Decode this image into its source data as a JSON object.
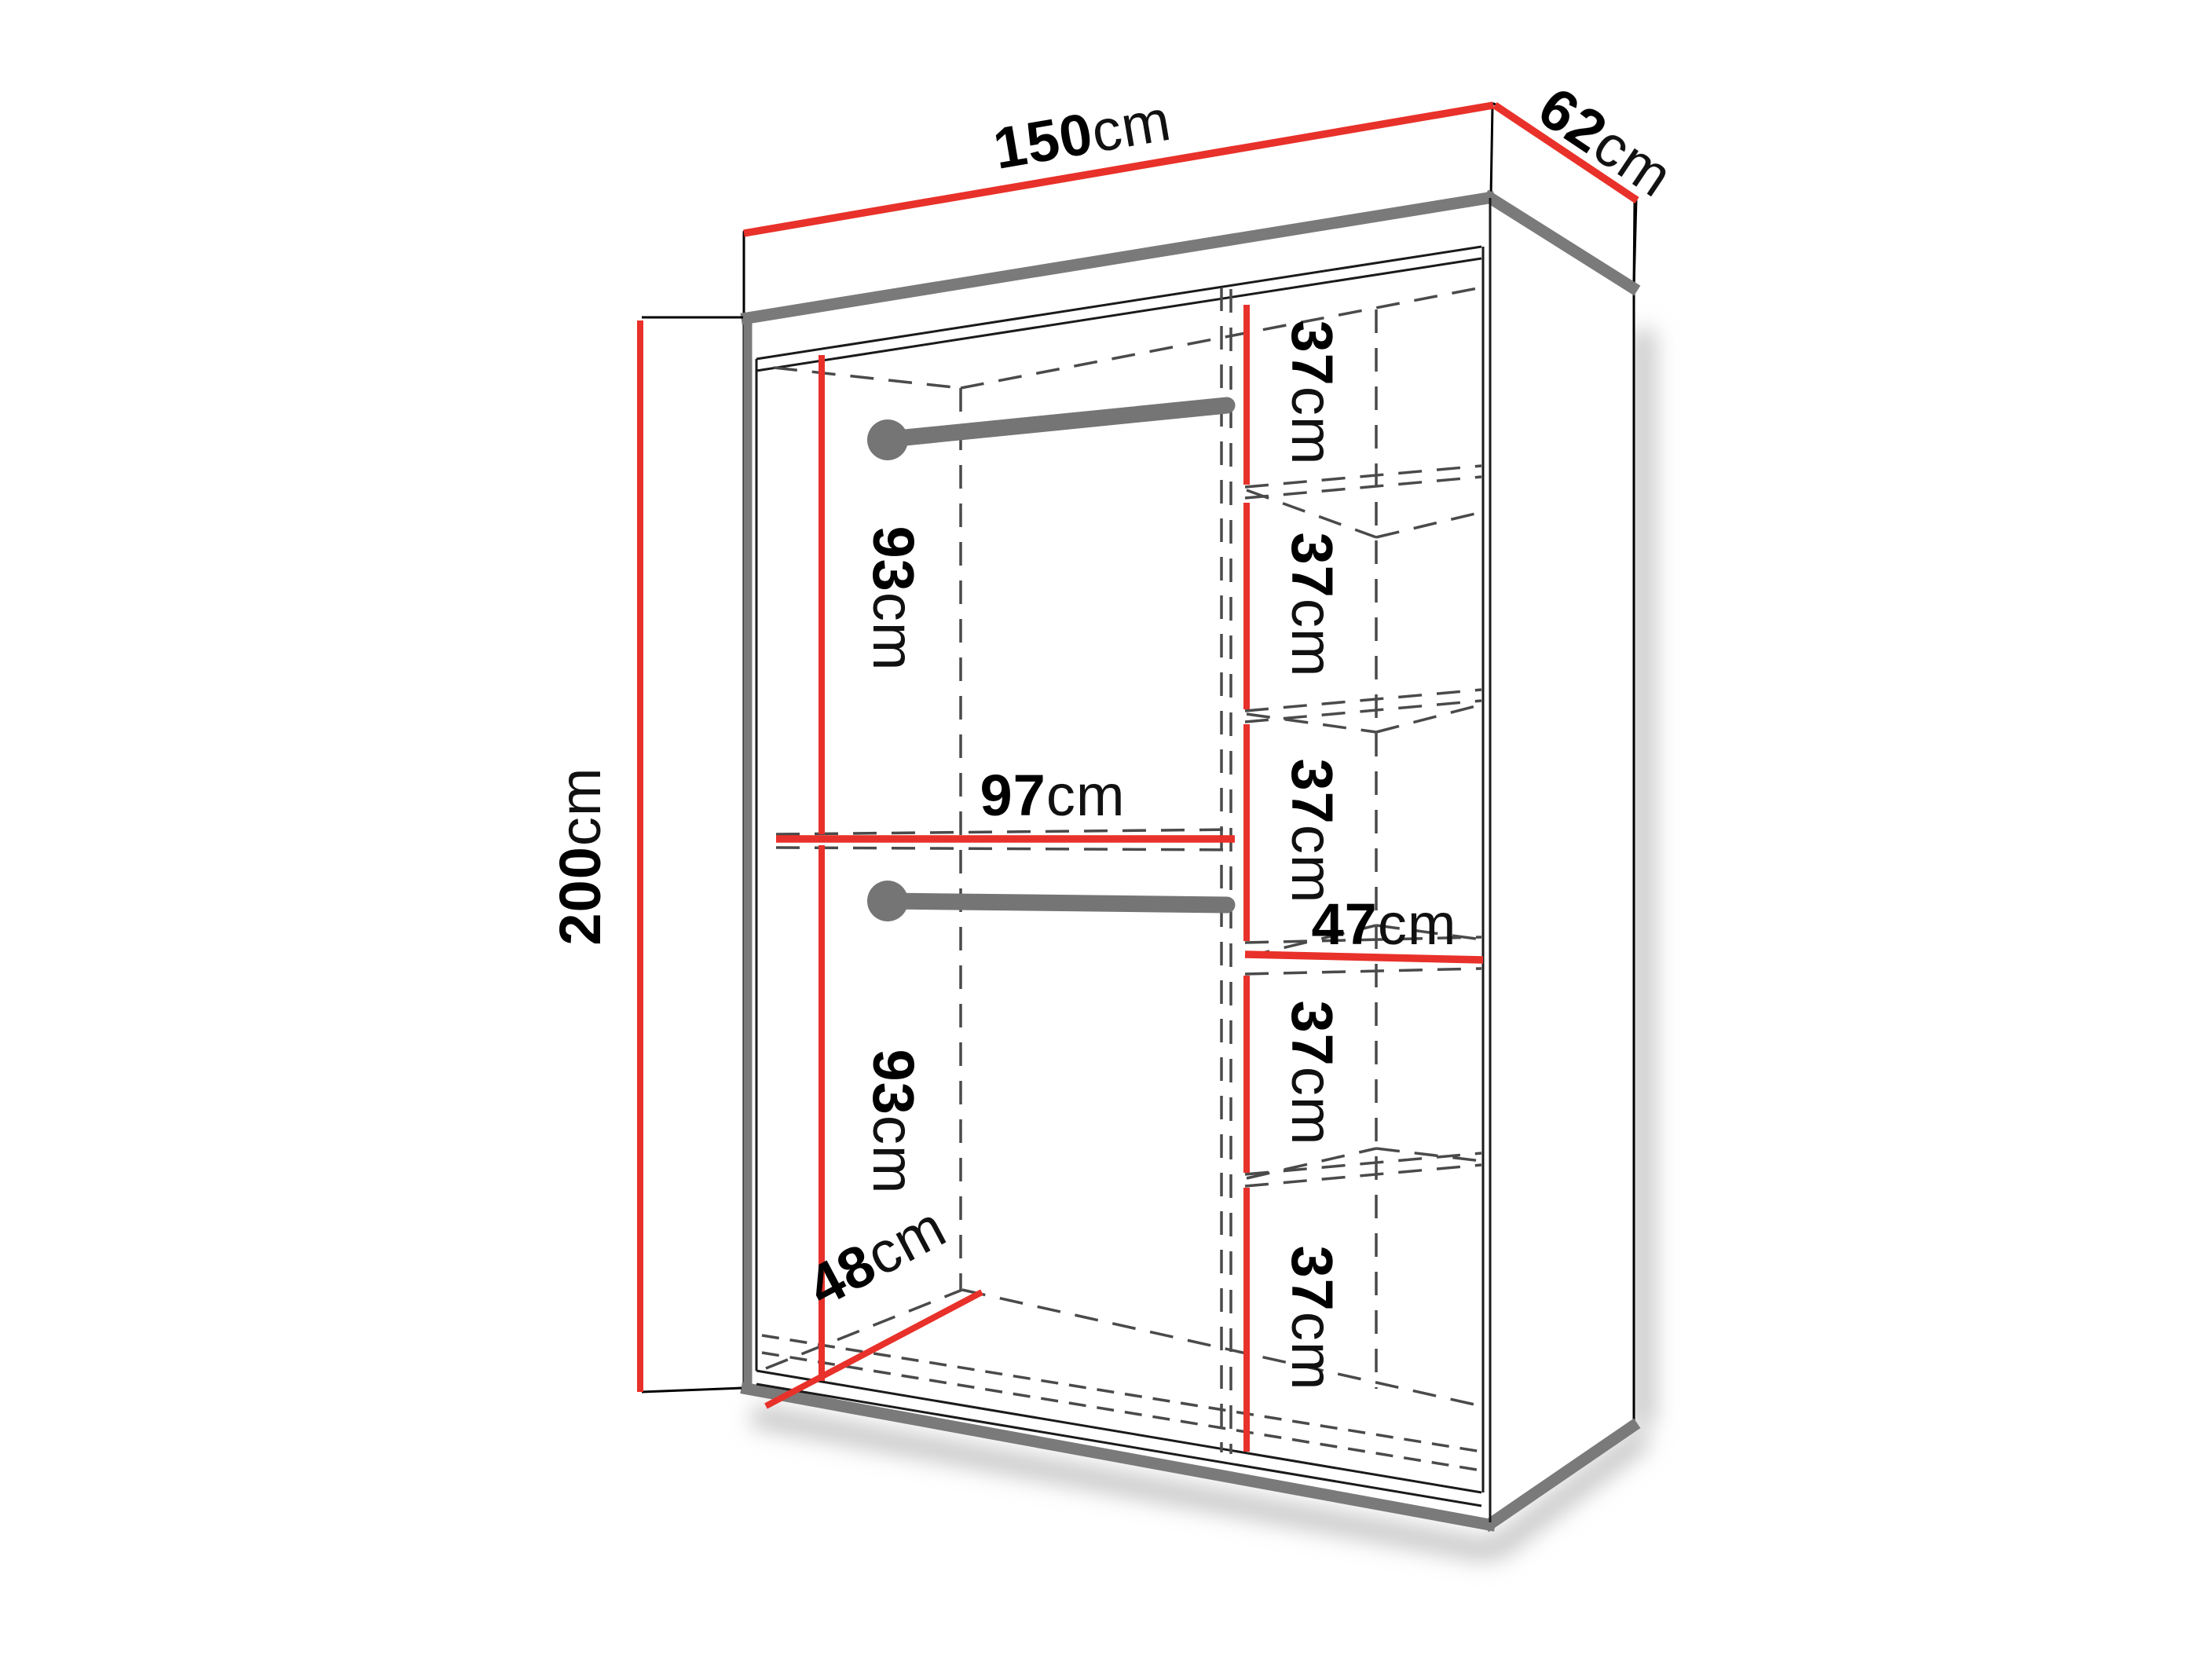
{
  "diagram": {
    "type": "furniture-dimension-diagram",
    "subject": "sliding-door wardrobe interior layout, perspective line drawing",
    "colors": {
      "dimension_line": "#e8312a",
      "structure_edge": "#7a7a7a",
      "outline": "#000000",
      "hidden_line": "#4a4a4a",
      "background": "#ffffff"
    },
    "dimensions": {
      "total_width": {
        "value": "150",
        "unit": "cm"
      },
      "total_depth": {
        "value": "62",
        "unit": "cm"
      },
      "total_height": {
        "value": "200",
        "unit": "cm"
      },
      "upper_hanging_height": {
        "value": "93",
        "unit": "cm"
      },
      "lower_hanging_height": {
        "value": "93",
        "unit": "cm"
      },
      "left_section_width": {
        "value": "97",
        "unit": "cm"
      },
      "shelf_section_width": {
        "value": "47",
        "unit": "cm"
      },
      "interior_depth": {
        "value": "48",
        "unit": "cm"
      },
      "shelf_spacings": [
        {
          "value": "37",
          "unit": "cm"
        },
        {
          "value": "37",
          "unit": "cm"
        },
        {
          "value": "37",
          "unit": "cm"
        },
        {
          "value": "37",
          "unit": "cm"
        },
        {
          "value": "37",
          "unit": "cm"
        }
      ]
    }
  }
}
